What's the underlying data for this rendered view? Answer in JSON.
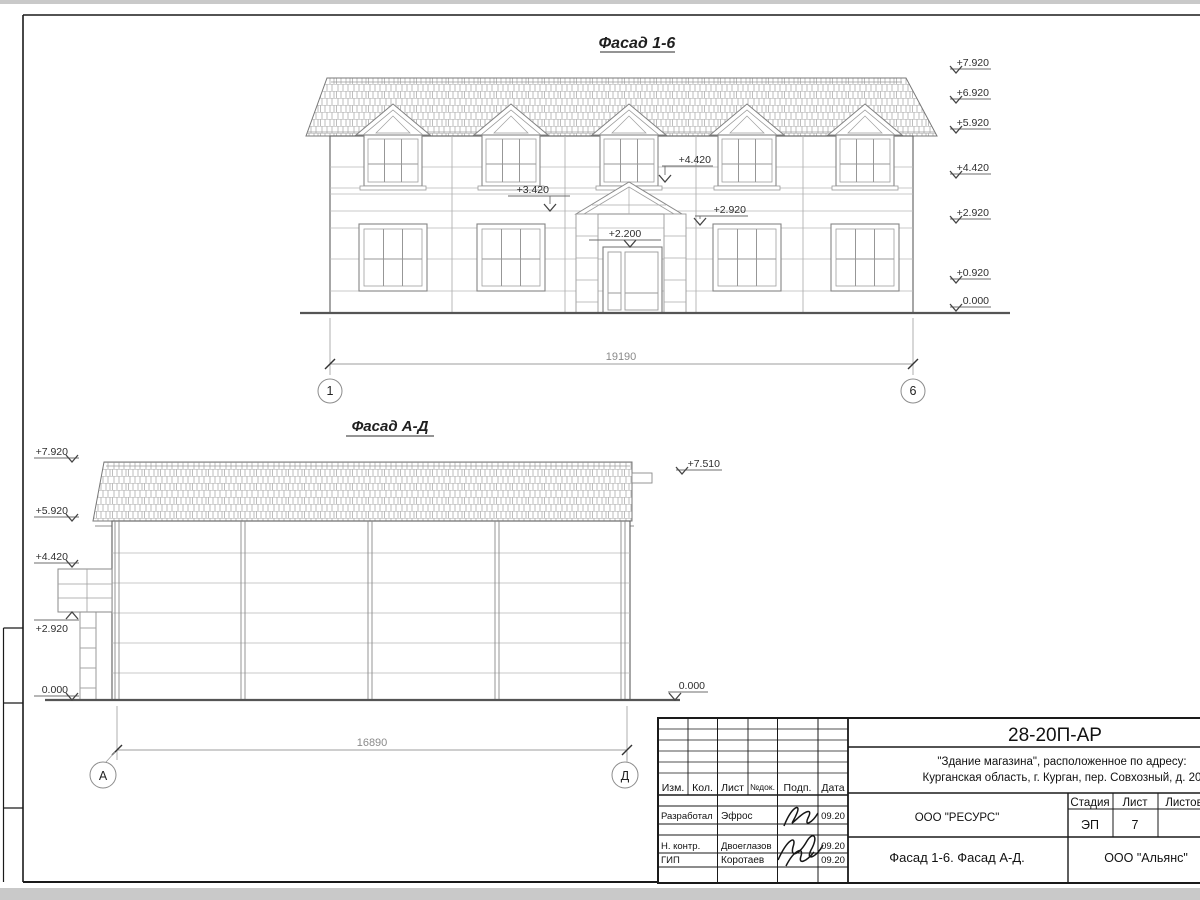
{
  "facade_top": {
    "title": "Фасад 1-6",
    "elevations_right": [
      "+7.920",
      "+6.920",
      "+5.920",
      "+4.420",
      "+2.920",
      "+0.920",
      "0.000"
    ],
    "mark_4420": "+4.420",
    "mark_3420": "+3.420",
    "mark_2920": "+2.920",
    "mark_2200": "+2.200",
    "dimension": "19190",
    "axis_left": "1",
    "axis_right": "6"
  },
  "facade_side": {
    "title": "Фасад А-Д",
    "elevations_left": [
      "+7.920",
      "+5.920",
      "+4.420",
      "+2.920",
      "0.000"
    ],
    "elevations_right": [
      "+7.510",
      "0.000"
    ],
    "dimension": "16890",
    "axis_left": "А",
    "axis_right": "Д"
  },
  "title_block": {
    "doc_code": "28-20П-АР",
    "project_line1": "\"Здание магазина\", расположенное по адресу:",
    "project_line2": "Курганская область, г. Курган, пер. Совхозный, д. 20",
    "designer_org": "ООО \"РЕСУРС\"",
    "sheet_title": "Фасад 1-6. Фасад А-Д.",
    "company": "ООО \"Альянс\"",
    "stage_label": "Стадия",
    "sheet_label": "Лист",
    "sheets_label": "Листов",
    "stage_value": "ЭП",
    "sheet_value": "7",
    "columns": [
      "Изм.",
      "Кол.",
      "Лист",
      "№док.",
      "Подп.",
      "Дата"
    ],
    "rows": [
      {
        "role": "Разработал",
        "name": "Эфрос",
        "date": "09.20"
      },
      {
        "role": "Н. контр.",
        "name": "Двоеглазов",
        "date": "09.20"
      },
      {
        "role": "ГИП",
        "name": "Коротаев",
        "date": "09.20"
      }
    ]
  }
}
